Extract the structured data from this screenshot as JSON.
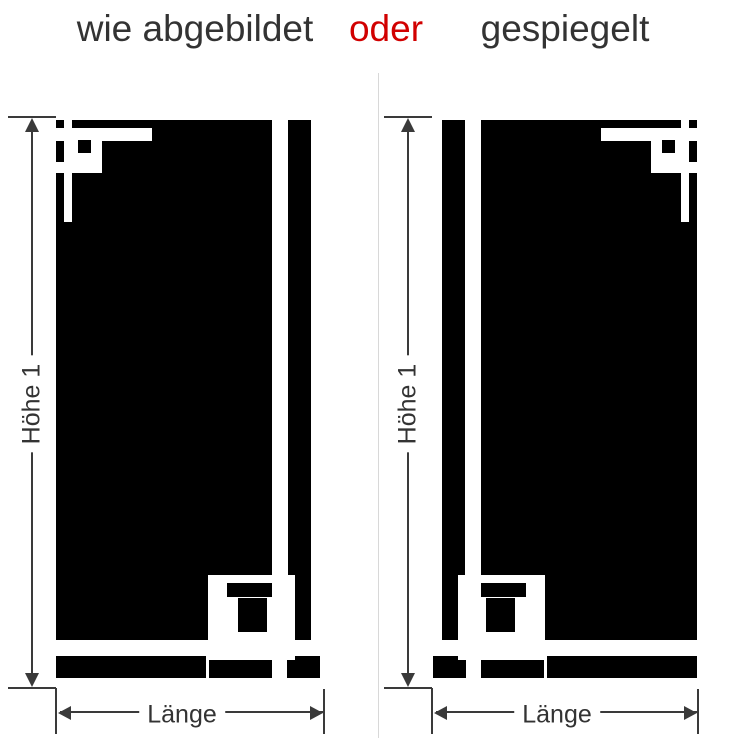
{
  "title": {
    "option_a": "wie abgebildet",
    "connector": "oder",
    "option_b": "gespiegelt"
  },
  "colors": {
    "ink": "#333333",
    "accent": "#d10000",
    "silhouette": "#000000",
    "divider": "#d8d8d8",
    "dimension": "#3a3a3a"
  },
  "figures": [
    {
      "variant": "wie abgebildet",
      "mirrored": false,
      "height_label": "Höhe 1",
      "length_label": "Länge"
    },
    {
      "variant": "gespiegelt",
      "mirrored": true,
      "height_label": "Höhe 1",
      "length_label": "Länge"
    }
  ]
}
